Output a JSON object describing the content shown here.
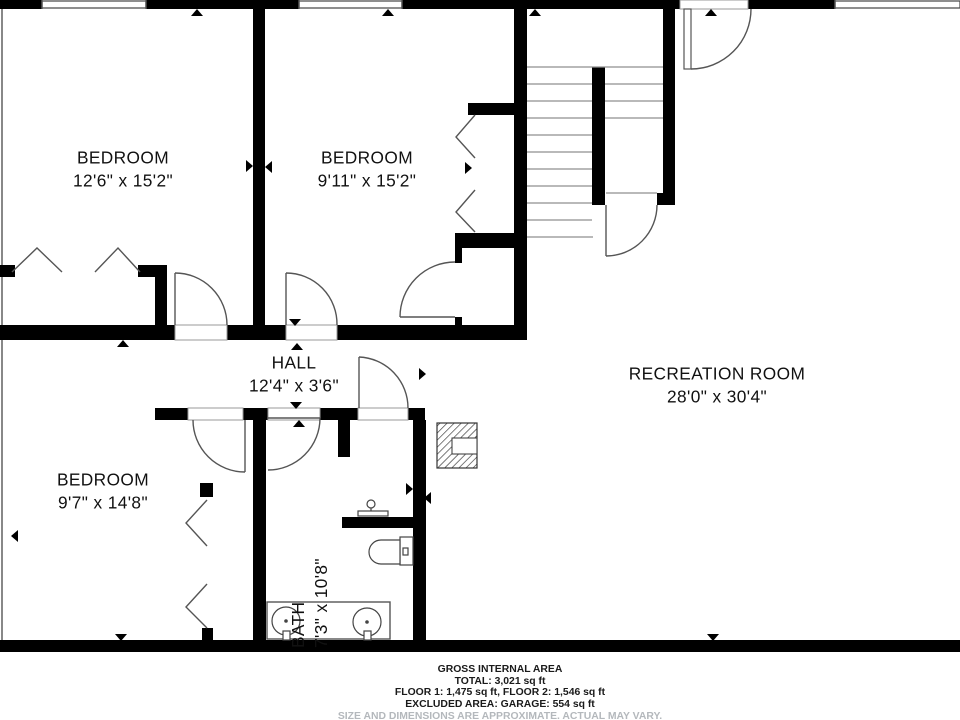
{
  "title": "Basement floor plan",
  "rooms": [
    {
      "name": "BEDROOM",
      "dims": "12'6\" x 15'2\""
    },
    {
      "name": "BEDROOM",
      "dims": "9'11\" x 15'2\""
    },
    {
      "name": "HALL",
      "dims": "12'4\" x 3'6\""
    },
    {
      "name": "BEDROOM",
      "dims": "9'7\" x 14'8\""
    },
    {
      "name": "BATH",
      "dims": "7'3\" x 10'8\""
    },
    {
      "name": "RECREATION ROOM",
      "dims": "28'0\" x 30'4\""
    }
  ],
  "footer": {
    "line1": "GROSS INTERNAL AREA",
    "line2": "TOTAL: 3,021 sq ft",
    "line3": "FLOOR 1: 1,475 sq ft, FLOOR 2: 1,546 sq ft",
    "line4": "EXCLUDED AREA: GARAGE: 554 sq ft",
    "disclaimer": "SIZE AND DIMENSIONS ARE APPROXIMATE. ACTUAL MAY VARY."
  },
  "colors": {
    "wall": "#000000",
    "thin": "#555555",
    "tread": "#8f8f8f",
    "disclaimer": "#b4b8bc"
  }
}
